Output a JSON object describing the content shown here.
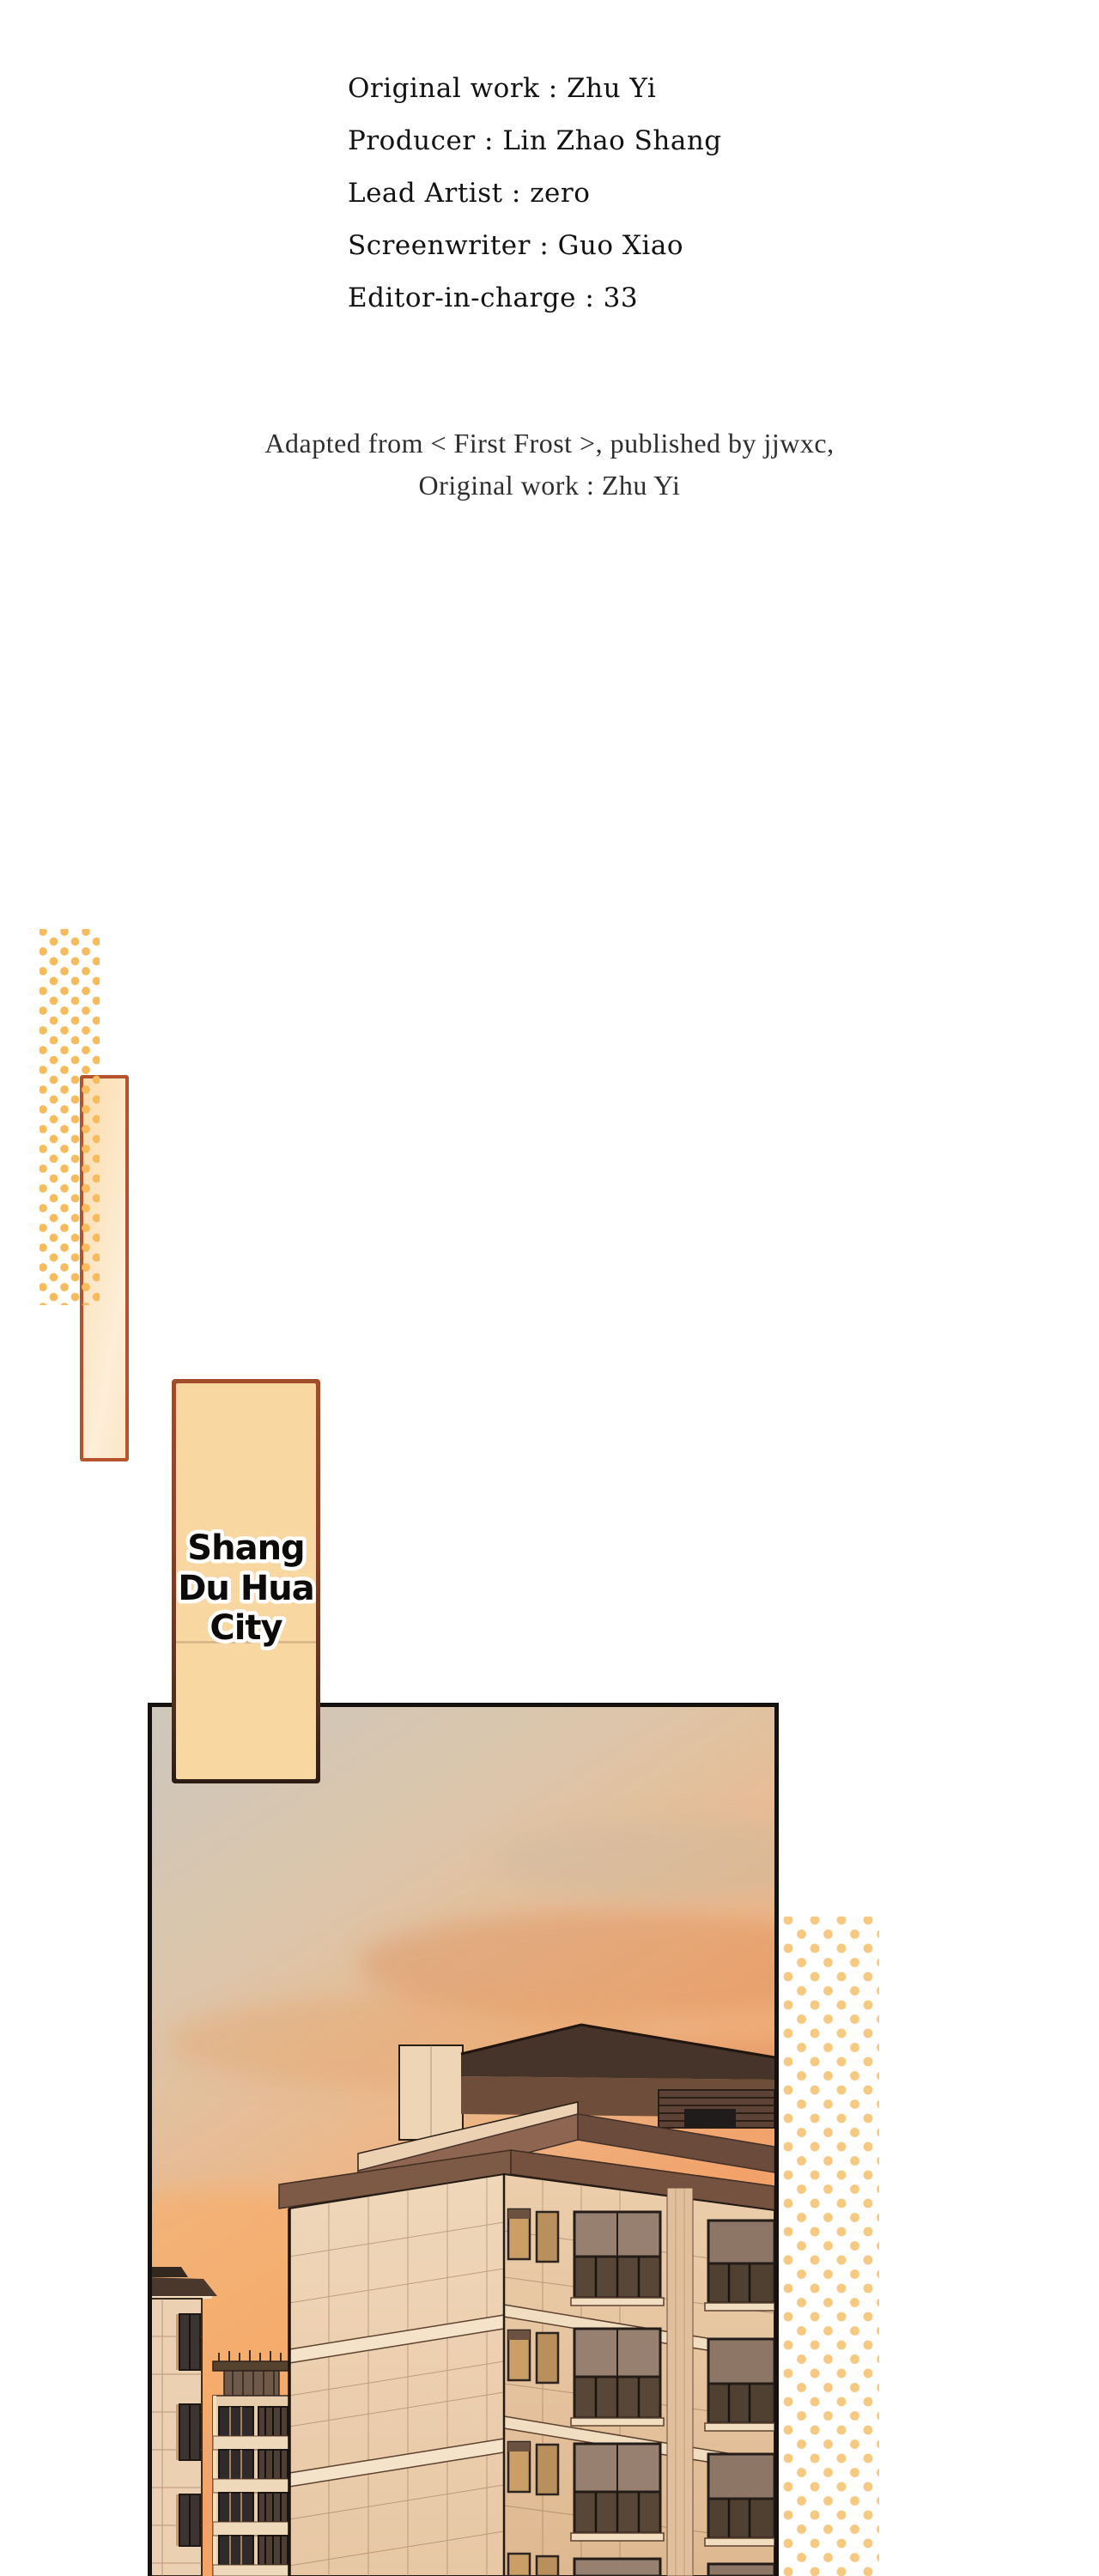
{
  "credits": {
    "lines": [
      "Original work : Zhu Yi",
      "Producer : Lin Zhao Shang",
      "Lead Artist : zero",
      "Screenwriter : Guo Xiao",
      "Editor-in-charge : 33"
    ]
  },
  "adaptation_note": {
    "line1": "Adapted from < First Frost >, published by jjwxc,",
    "line2": "Original work : Zhu Yi"
  },
  "location_label": {
    "lines": [
      "Shang",
      "Du Hua",
      "City"
    ]
  },
  "colors": {
    "page_bg": "#ffffff",
    "credits_text": "#121212",
    "note_text": "#2e2e2e",
    "dots_left": "#f6bb5c",
    "dots_right": "#f6c983",
    "tall_rect_border": "#b4532e",
    "tall_rect_fill_start": "#fbdcae",
    "tall_rect_fill_end": "#fdf0dc",
    "label_fill": "#f8d7a1",
    "label_border_top": "#a04d2c",
    "label_border_bottom": "#2c1c14",
    "label_text": "#0d0b09",
    "label_text_outline": "#ffffff",
    "panel_border": "#15110e",
    "sky_top": "#cdc7bc",
    "sky_mid": "#ecb88b",
    "sky_bottom": "#f8a75f",
    "cloud": "#dd8a4e",
    "facade_light": "#f0d7ba",
    "facade_shadow": "#deb890",
    "trim_dark": "#6e4d3b",
    "trim_mid": "#8d6550",
    "window_glass_dark": "#3b3430",
    "window_glass_lit": "#c99e67",
    "outline": "#241a14"
  }
}
